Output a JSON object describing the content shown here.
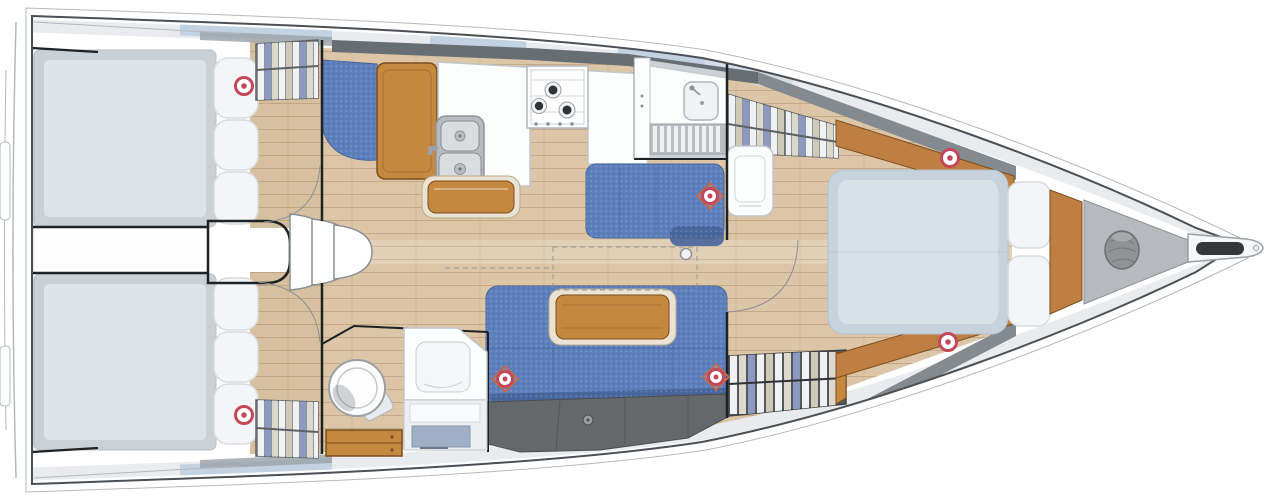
{
  "colors": {
    "hull_line": "#4a5055",
    "hull_thin": "#b3b9bd",
    "black_line": "#1f2225",
    "thin_line": "#8b9096",
    "deck_light": "#e9ebee",
    "deck_blue": "#c3d2e3",
    "deck_blue_soft": "#d4dde8",
    "deck_dark": "#666d73",
    "deck_mid": "#838a90",
    "floor_salon": "#dcc6a7",
    "floor_aft": "#d7c09f",
    "wood_hi": "#c4883f",
    "wood_edge": "#7d4e1e",
    "wood_trim": "#bf7f42",
    "trim_cream": "#eae3d3",
    "bed_lo": "#c9d1d6",
    "bed_hi": "#dde3e6",
    "fbed_lo": "#c6d3dc",
    "fbed_hi": "#d7e1e8",
    "pillow": "#f4f5f6",
    "pillow_line": "#d8dcdf",
    "denim": "#5d80bd",
    "denim_dark": "#47649b",
    "storage": "#65686a",
    "storage_line": "#4b4e50",
    "wardrobe_bg": "#8f969b",
    "wardrobe_dark": "#55595e",
    "cloth_a": "#f0f1f3",
    "cloth_b": "#8e99c2",
    "cloth_c": "#cfc9b8",
    "cloth_d": "#dcd8cc",
    "steel_lo": "#b6bbc0",
    "steel_hi": "#d9dde0",
    "white_fixture": "#fcfdfd",
    "fixture_line": "#c0c5c9",
    "locker_gray": "#b6babe",
    "rope_gray": "#8f9396",
    "marker_red": "#c2485a",
    "marker_diamond": "#c66a4a",
    "burner_dark": "#2f3336"
  },
  "floor_plan": {
    "regions": [
      {
        "name": "aft-cabin-port",
        "items": [
          "double-berth",
          "pillows",
          "hanging-locker",
          "deck-hatch"
        ]
      },
      {
        "name": "aft-cabin-starboard",
        "items": [
          "double-berth",
          "pillows",
          "hanging-locker",
          "deck-hatch"
        ]
      },
      {
        "name": "companionway",
        "items": [
          "steps",
          "engine-compartment"
        ]
      },
      {
        "name": "galley",
        "items": [
          "counter",
          "double-sink",
          "three-burner-stove",
          "island-unit",
          "nav-seat",
          "chart-table"
        ]
      },
      {
        "name": "salon",
        "items": [
          "port-settee",
          "starboard-settee",
          "folding-table",
          "storage-lockers",
          "hanging-locker",
          "mast-post"
        ]
      },
      {
        "name": "aft-head",
        "items": [
          "toilet",
          "vanity-sink",
          "drawers"
        ]
      },
      {
        "name": "forward-head",
        "items": [
          "sink",
          "shower-grate",
          "locker"
        ]
      },
      {
        "name": "forward-cabin",
        "items": [
          "island-berth",
          "pillows",
          "hanging-lockers",
          "cabinet",
          "side-trims",
          "deck-hatches"
        ]
      },
      {
        "name": "bow",
        "items": [
          "anchor-locker",
          "rope-coil",
          "bowsprit",
          "anchor-roller"
        ]
      }
    ],
    "deck_hatch_count": 7
  }
}
